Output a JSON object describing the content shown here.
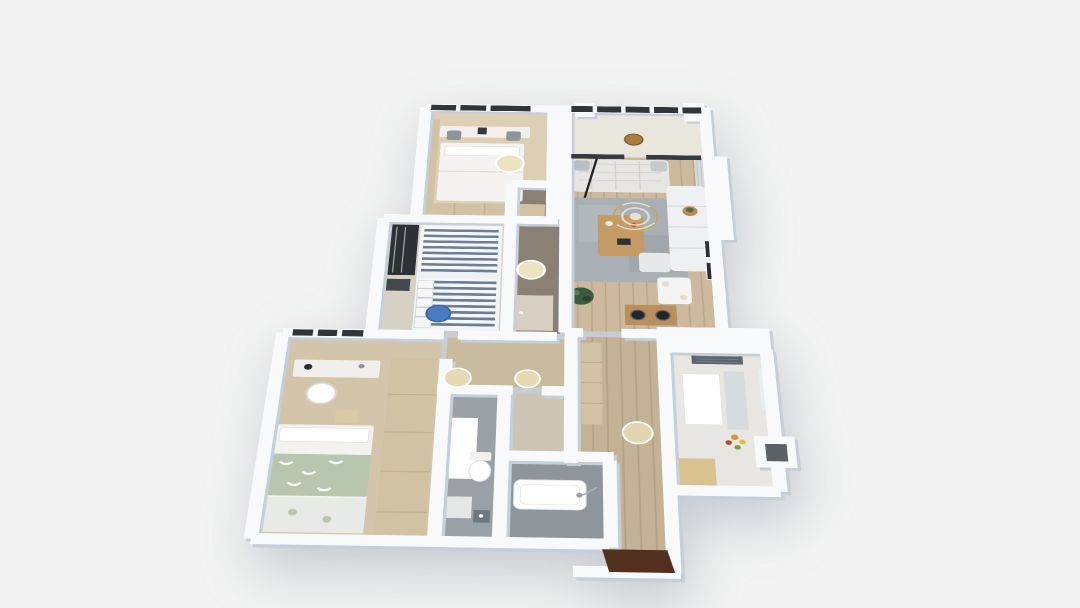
{
  "scene": {
    "description": "3D rendered apartment floor plan, top-down axonometric dollhouse view",
    "background": "#f2f3f2"
  },
  "palette": {
    "wall_top": "#f7f9fb",
    "wall_shade": "#c6cfd9",
    "window_frame_dark": "#2f353b",
    "window_mullion": "#f5f6f7",
    "curtain_gray": "#d7dadd",
    "rug_gray": "#a9b0b5",
    "sofa_white": "#eef0f1",
    "daybed_quilt": "#e7e6e3",
    "coffee_table_wood": "#c49a67",
    "sideboard_wood": "#b9905d",
    "chandelier_gold": "#c9a54f",
    "plant_green": "#3c5a3e",
    "wardrobe_dark": "#2c3136",
    "bed_floral_green": "#b8c6b0",
    "bunkbed_stripe_blue": "#6d7f96",
    "cabinet_beige": "#d2c2a4",
    "kitchen_strip_beige": "#d8c28f",
    "hood_gray": "#5d646b",
    "appliance_white": "#ffffff",
    "entry_mat_brown": "#53301d",
    "door_leaf": "#d6cfc2",
    "shower_glass": "#ffffff"
  },
  "rooms": [
    {
      "id": "bedroom-top",
      "floor": "#dccfb4"
    },
    {
      "id": "balcony",
      "floor": "#e9e6de"
    },
    {
      "id": "living-room",
      "floor": "#cdb99d"
    },
    {
      "id": "hallway-dark",
      "floor": "#8a8174"
    },
    {
      "id": "kids-bedroom",
      "floor": "#d7d1c5"
    },
    {
      "id": "master-bedroom",
      "floor": "#d2c5aa"
    },
    {
      "id": "inner-hall",
      "floor": "#c9bb9e"
    },
    {
      "id": "bathroom-shower",
      "floor": "#9aa1a6"
    },
    {
      "id": "closet",
      "floor": "#cdc5b4"
    },
    {
      "id": "bathroom-tub",
      "floor": "#8e959b"
    },
    {
      "id": "corridor",
      "floor": "#c3b295"
    },
    {
      "id": "kitchen",
      "floor": "#e7e6e2"
    }
  ],
  "markers": [
    {
      "id": "ceiling-light-bedroom-top",
      "kind": "ceiling-light",
      "color": "#eee3c0"
    },
    {
      "id": "pendant-light-balcony",
      "kind": "pendant-light",
      "color": "#a87c3c"
    },
    {
      "id": "ceiling-light-hallway",
      "kind": "ceiling-light",
      "color": "#eee3c0"
    },
    {
      "id": "ceiling-fixture-blue",
      "kind": "ceiling-fixture",
      "color": "#4a7cc1"
    },
    {
      "id": "ceiling-light-inner-hall-1",
      "kind": "ceiling-light",
      "color": "#e6d9b4"
    },
    {
      "id": "ceiling-light-inner-hall-2",
      "kind": "ceiling-light",
      "color": "#e6d9b4"
    },
    {
      "id": "ceiling-light-corridor",
      "kind": "ceiling-light",
      "color": "#e2d5b0"
    }
  ]
}
